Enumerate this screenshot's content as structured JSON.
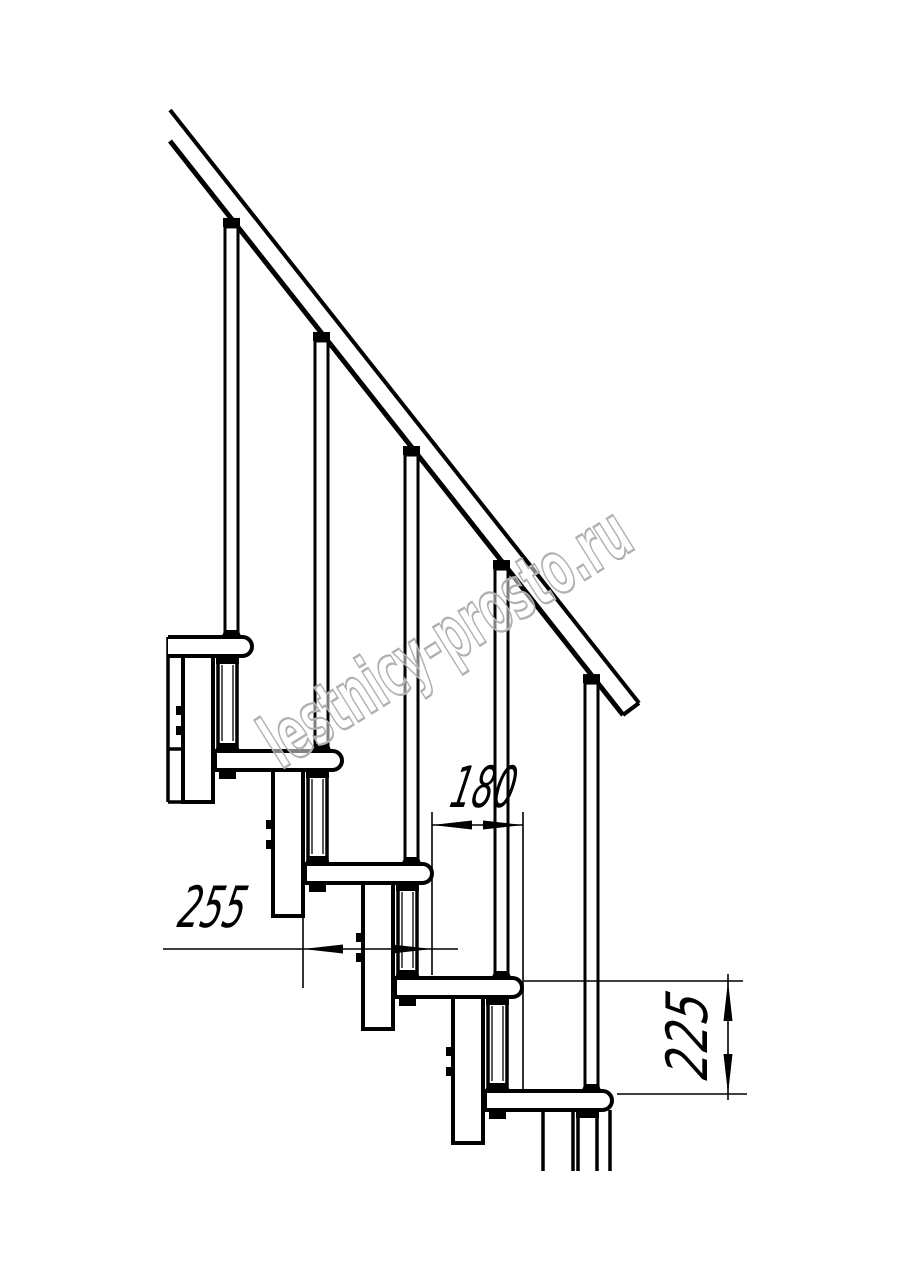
{
  "meta": {
    "kind": "technical-drawing",
    "subject": "Side elevation fragment of a modular staircase with handrail, balusters and step dimensions"
  },
  "watermark": {
    "text": "lestnicy-prosto.ru",
    "color": "#b0b0b0",
    "fill_opacity": 0.5,
    "x": 281,
    "y": 770,
    "rotate": -32,
    "font_size": 74,
    "text_length": 420,
    "stroke_width": 2.4
  },
  "drawing": {
    "canvas": {
      "width": 914,
      "height": 1280,
      "background": "#ffffff",
      "line_color": "#000000"
    },
    "handrail": {
      "upper_edge": [
        170,
        110,
        639,
        703
      ],
      "lower_edge": [
        170,
        141,
        623,
        715
      ],
      "end_cut": [
        639,
        703,
        623,
        715
      ],
      "stroke_upper": 4,
      "stroke_lower": 5,
      "stroke_cut": 4
    },
    "stairs": {
      "count": 5,
      "right_x0": 252,
      "top_y0": 637,
      "dx": 90,
      "dy": 113.5,
      "tread": {
        "length": 127,
        "height": 19,
        "radius": 9.5,
        "stroke": 4
      },
      "baluster": {
        "off_center": -20.5,
        "width": 13,
        "stroke": 3,
        "cap_w": 17,
        "cap_h": 9,
        "foot_w": 20,
        "foot_h": 7
      },
      "post": {
        "off_left": -34,
        "width": 19,
        "stroke": 3.5,
        "inner_inset": 4,
        "inner_stroke": 1.3,
        "conn_w": 23,
        "conn_h": 8,
        "foot_w": 25,
        "foot_h": 8,
        "nut_w": 17,
        "nut_h": 9
      },
      "column": {
        "off_left": -69,
        "width": 30,
        "depth": 165,
        "stroke": 4,
        "bolt_dy1": 69,
        "bolt_dy2": 89,
        "bolt_w": 7,
        "bolt_h": 9
      },
      "first_tread_left": 168,
      "clip_lines": [
        [
          168,
          637,
          168,
          802
        ],
        [
          168,
          749,
          183,
          749
        ],
        [
          168,
          802,
          184,
          802
        ]
      ],
      "cut_lines_x": [
        543,
        573,
        578,
        597,
        610
      ],
      "cut_lines_y1": 1110,
      "cut_lines_y2": 1171
    },
    "dimensions": [
      {
        "id": "step-run",
        "label": "180",
        "value_mm": 180,
        "orientation": "horizontal",
        "line": [
          432,
          825,
          523,
          825
        ],
        "ext_lines": [
          [
            432,
            812,
            432,
            975
          ],
          [
            523,
            812,
            523,
            1092
          ]
        ],
        "arrows": [
          {
            "apex": [
              432,
              825
            ],
            "dir": [
              -1,
              0
            ]
          },
          {
            "apex": [
              523,
              825
            ],
            "dir": [
              1,
              0
            ]
          }
        ],
        "text": {
          "x": 448,
          "y": 807,
          "rotate": 0,
          "skew": -12,
          "size": 57,
          "text_length": 64
        }
      },
      {
        "id": "tread-length",
        "label": "255",
        "value_mm": 255,
        "orientation": "horizontal",
        "line": [
          163,
          949,
          458,
          949
        ],
        "ext_lines": [
          [
            303,
            900,
            303,
            988
          ]
        ],
        "arrows": [
          {
            "apex": [
              303,
              949
            ],
            "dir": [
              -1,
              0
            ]
          },
          {
            "apex": [
              432,
              949
            ],
            "dir": [
              1,
              0
            ]
          }
        ],
        "text": {
          "x": 176,
          "y": 927,
          "rotate": 0,
          "skew": -12,
          "size": 57,
          "text_length": 66
        }
      },
      {
        "id": "step-rise",
        "label": "225",
        "value_mm": 225,
        "orientation": "vertical",
        "line": [
          728,
          974,
          728,
          1100
        ],
        "ext_lines": [
          [
            524,
            981,
            743,
            981
          ],
          [
            617,
            1094,
            747,
            1094
          ]
        ],
        "arrows": [
          {
            "apex": [
              728,
              981
            ],
            "dir": [
              0,
              -1
            ]
          },
          {
            "apex": [
              728,
              1094
            ],
            "dir": [
              0,
              1
            ]
          }
        ],
        "text": {
          "x": 707,
          "y": 1081,
          "rotate": -90,
          "skew": -12,
          "size": 57,
          "text_length": 84
        }
      }
    ]
  }
}
